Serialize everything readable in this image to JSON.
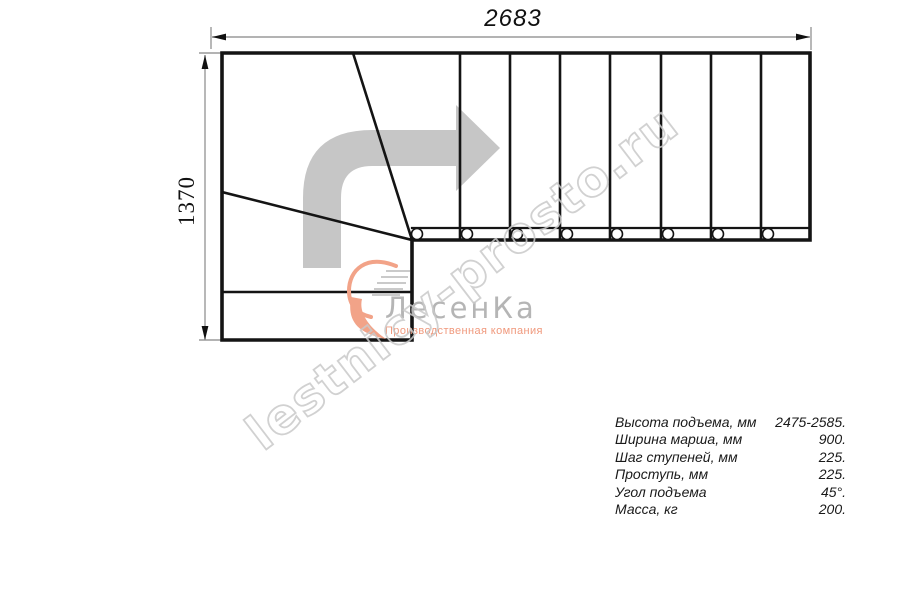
{
  "drawing": {
    "title": "staircase-plan",
    "top_dimension_label": "2683",
    "left_dimension_label": "1370",
    "straight_flight_treads": 8,
    "winder_treads": 3,
    "baluster_count": 8
  },
  "watermark": {
    "text": "lestnicy-prosto.ru"
  },
  "logo": {
    "name": "ЛесенКа",
    "tagline": "Производственная компания"
  },
  "specs": {
    "rows": [
      {
        "label": "Высота подъема, мм",
        "value": "2475-2585."
      },
      {
        "label": "Ширина марша, мм",
        "value": "900."
      },
      {
        "label": "Шаг ступеней, мм",
        "value": "225."
      },
      {
        "label": "Проступь, мм",
        "value": "225."
      },
      {
        "label": "Угол подъема",
        "value": "45°."
      },
      {
        "label": "Масса, кг",
        "value": "200."
      }
    ]
  },
  "icons": {
    "direction_arrow": "bent-arrow-up-then-right",
    "logo_emblem": "salmon-swoosh-with-speed-lines"
  },
  "colors": {
    "plan_line": "#141414",
    "dimension_line": "#9a9a9a",
    "arrow_gray": "#c6c6c6",
    "watermark_gray": "#c9c9c9",
    "logo_gray": "#b5b5b5",
    "logo_salmon": "#f0997d",
    "background": "#ffffff"
  }
}
